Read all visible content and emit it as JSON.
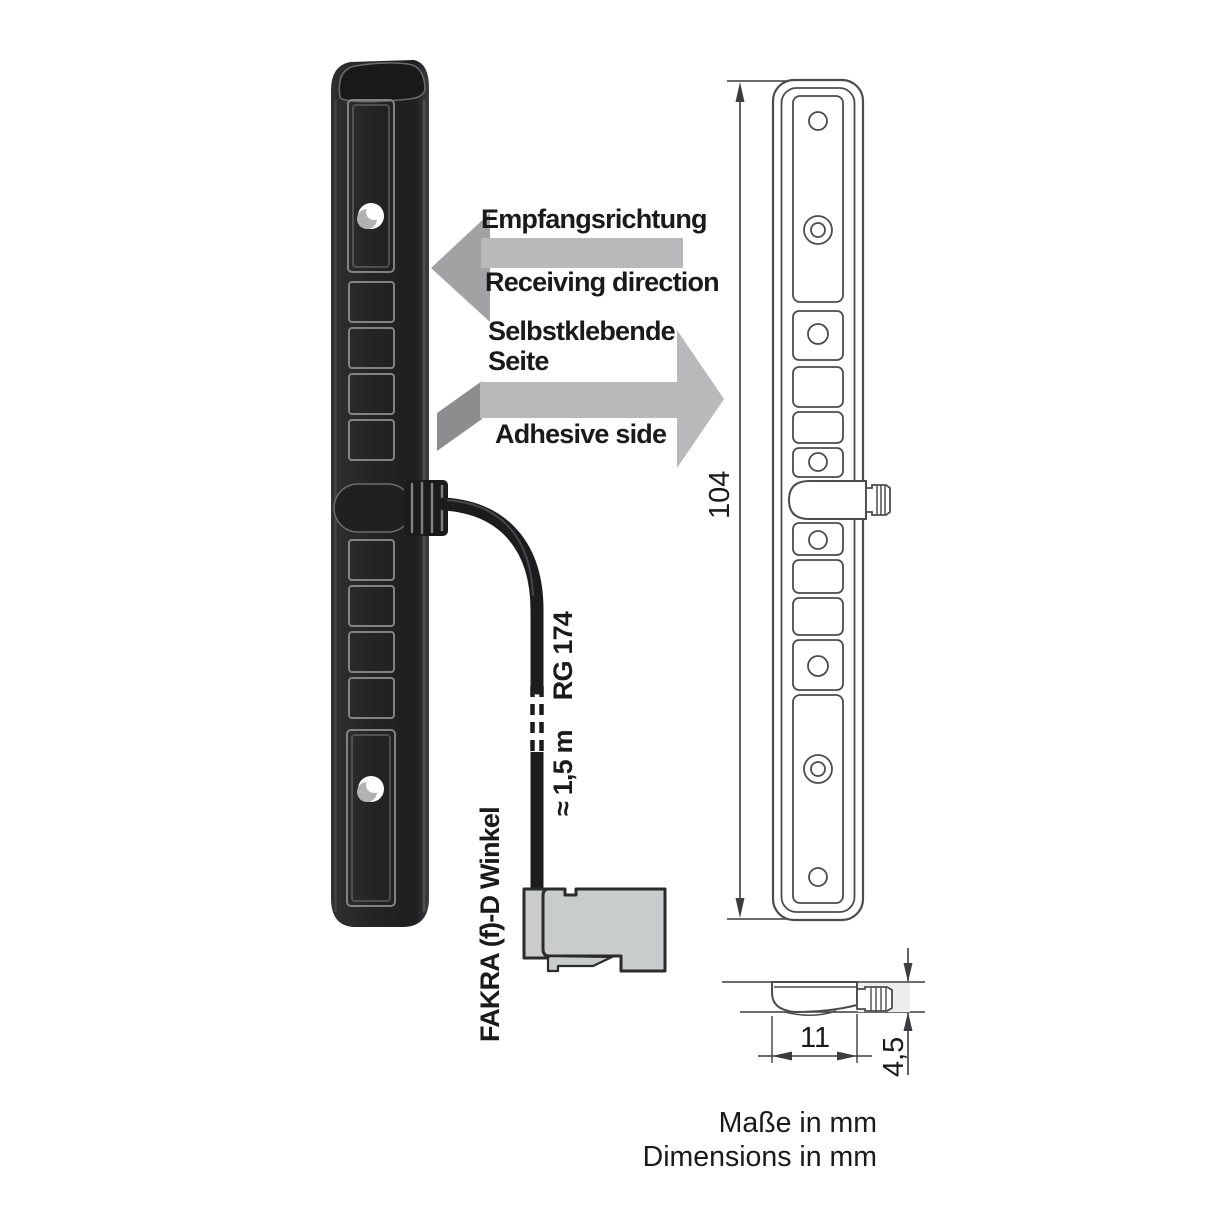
{
  "illustration": {
    "arrows": {
      "receiving": {
        "de": "Empfangsrichtung",
        "en": "Receiving direction"
      },
      "adhesive": {
        "de1": "Selbstklebende",
        "de2": "Seite",
        "en": "Adhesive side"
      }
    },
    "cable": {
      "length": "≈ 1,5 m",
      "type": "RG 174"
    },
    "connector_label": "FAKRA (f)-D Winkel"
  },
  "dimensions": {
    "height": "104",
    "width": "11",
    "depth": "4,5",
    "note_de": "Maße in mm",
    "note_en": "Dimensions in mm"
  },
  "colors": {
    "arrow-body": "#b9b9bb",
    "arrow-head": "#a2a2a4",
    "arrow-tail": "#8d8d8f",
    "antenna-dark": "#242426",
    "cable-black": "#1c1c1e",
    "connector-gray": "#c9cccd",
    "line": "#4c4c4e",
    "dim-line": "#3d3d3f",
    "shade": "#ededee",
    "text": "#1a1a1a"
  }
}
